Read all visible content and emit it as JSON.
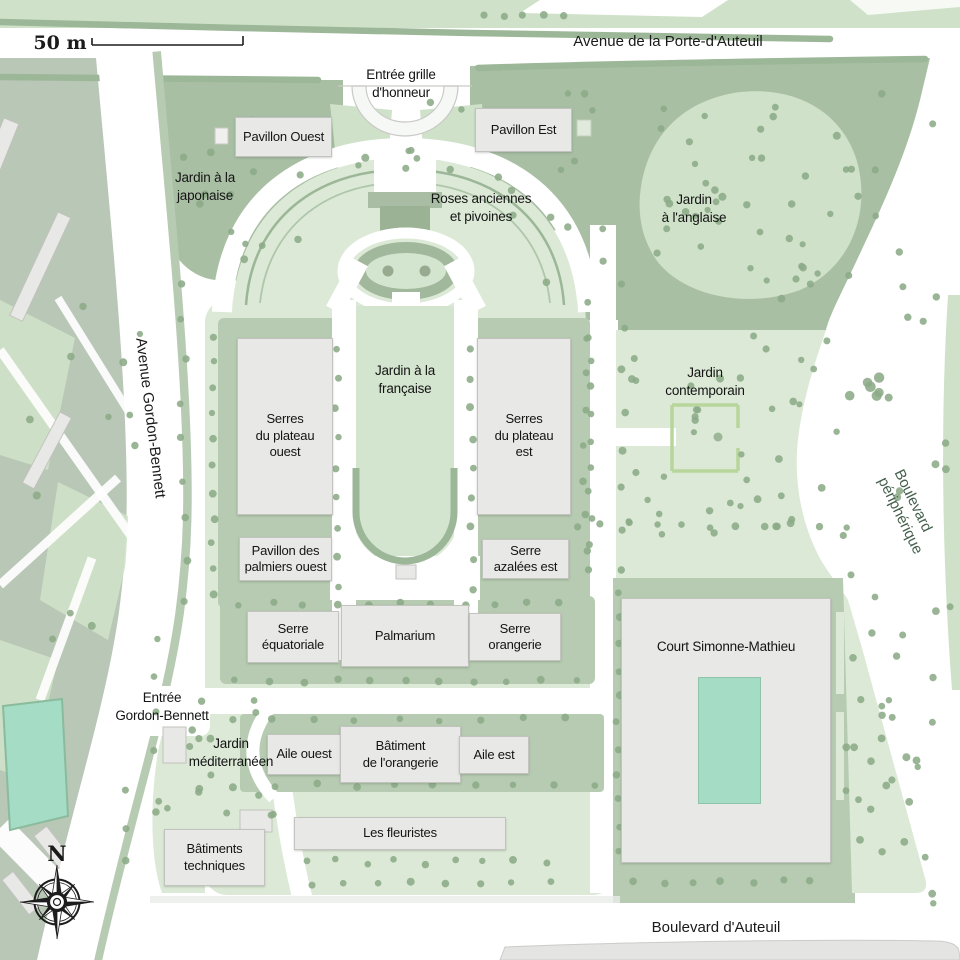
{
  "scale_bar": {
    "label": "50 m"
  },
  "compass": {
    "north_label": "N"
  },
  "streets": {
    "avenue_porte_auteuil": "Avenue de la Porte-d'Auteuil",
    "avenue_gordon_bennett": "Avenue Gordon-Bennett",
    "boulevard_peripherique": "Boulevard périphérique",
    "boulevard_auteuil": "Boulevard d'Auteuil"
  },
  "entrances": {
    "grille_honneur": "Entrée grille\nd'honneur",
    "gordon_bennett": "Entrée\nGordon-Bennett"
  },
  "gardens": {
    "japonaise": "Jardin à la\njaponaise",
    "anglaise": "Jardin\nà l'anglaise",
    "roses": "Roses anciennes\net pivoines",
    "francaise": "Jardin à la\nfrançaise",
    "contemporain": "Jardin\ncontemporain",
    "mediterraneen": "Jardin\nméditerranéen"
  },
  "buildings": {
    "pavillon_ouest": "Pavillon Ouest",
    "pavillon_est": "Pavillon Est",
    "serres_plateau_ouest": "Serres\ndu plateau\nouest",
    "serres_plateau_est": "Serres\ndu plateau\nest",
    "pavillon_palmiers_ouest": "Pavillon des\npalmiers ouest",
    "serre_azalees_est": "Serre\nazalées est",
    "serre_equatoriale": "Serre\néquatoriale",
    "palmarium": "Palmarium",
    "serre_orangerie": "Serre\norangerie",
    "court_simonne_mathieu": "Court Simonne-Mathieu",
    "aile_ouest": "Aile ouest",
    "batiment_orangerie": "Bâtiment\nde l'orangerie",
    "aile_est": "Aile est",
    "les_fleuristes": "Les fleuristes",
    "batiments_techniques": "Bâtiments\ntechniques"
  },
  "colors": {
    "lawn_light": "#dbe9d6",
    "lawn_fra": "#d4e5cf",
    "lawn_pale": "#cfe2c9",
    "green_medium": "#a9bfa4",
    "green_pad": "#b6cbb1",
    "ribbon": "#9cb797",
    "city_block": "#b9c7b6",
    "building_fill": "#e8e8e6",
    "building_border": "#c2c2be",
    "court_teal": "#a5dcc6",
    "tree_dot": "#8cab88",
    "road_white": "#ffffff",
    "label_text": "#1a1a1a",
    "peripherique_text": "#45604c"
  }
}
